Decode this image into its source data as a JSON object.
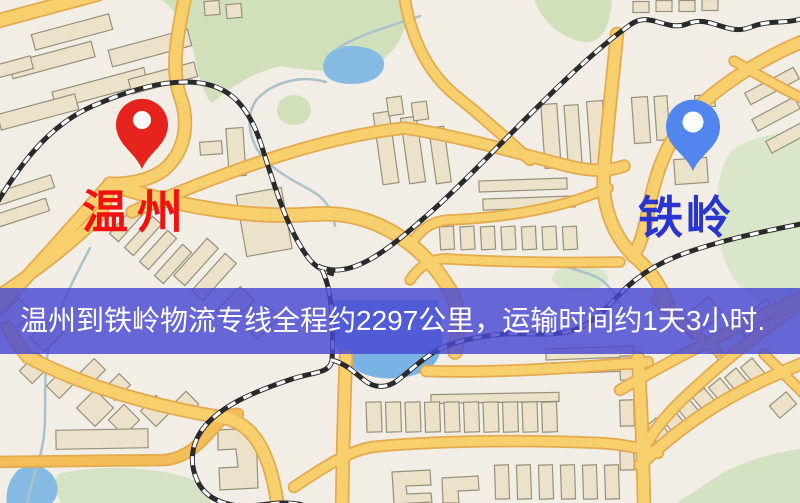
{
  "map": {
    "origin": {
      "label": "温州",
      "pin_color": "#e6231c",
      "label_color": "#f21010"
    },
    "destination": {
      "label": "铁岭",
      "pin_color": "#5286ee",
      "label_color": "#2a35cf"
    },
    "banner": {
      "text": "温州到铁岭物流专线全程约2297公里，运输时间约1天3小时.",
      "background": "rgba(72,72,210,0.82)",
      "text_color": "#ffffff"
    },
    "route": {
      "distance_km": "2297",
      "duration": "1天3小时"
    },
    "colors": {
      "map_background": "#f2eee6",
      "road_fill": "#f7cf6d",
      "road_casing": "#e3aa4f",
      "building_fill": "#ece2c9",
      "building_outline": "#98907c",
      "green_area": "#cfe0ba",
      "water": "#85bbe2",
      "railway": "#2a2a2a"
    }
  }
}
